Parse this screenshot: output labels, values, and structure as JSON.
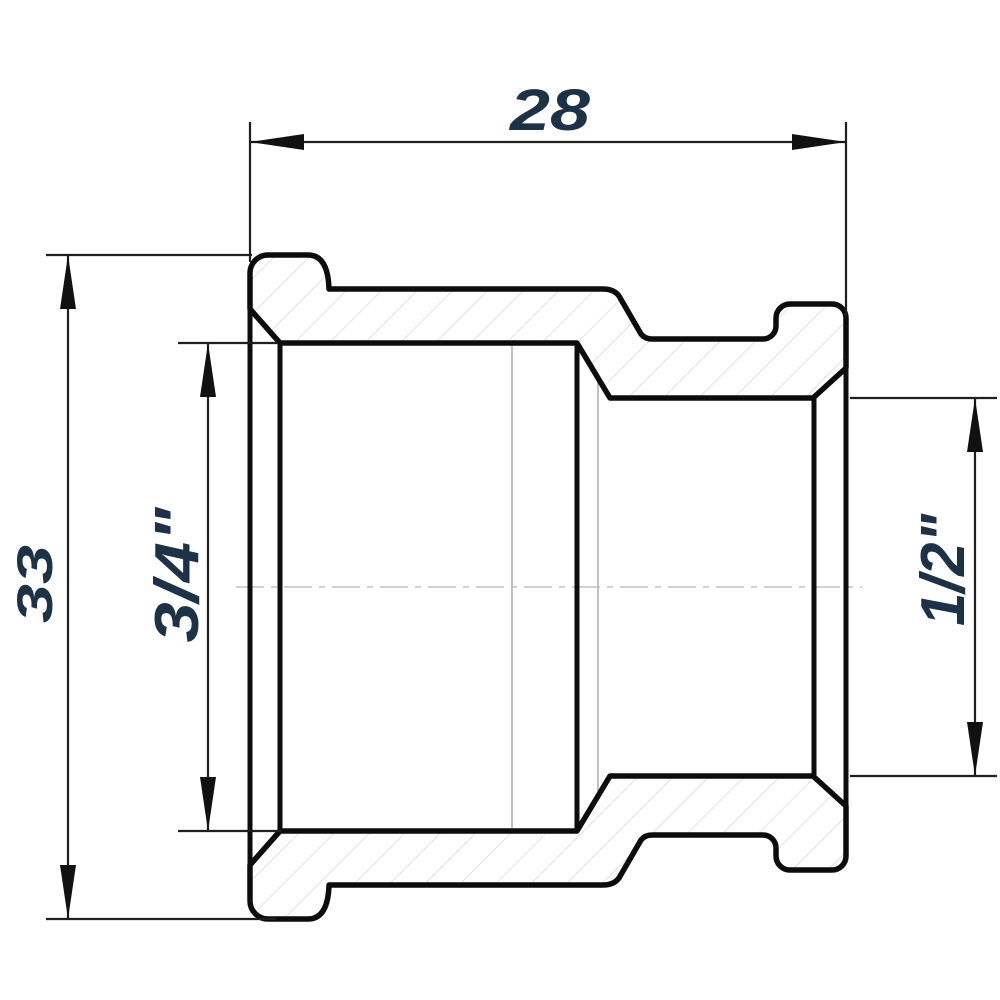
{
  "drawing": {
    "dimensions": {
      "width": "28",
      "height": "33",
      "left_thread": "3/4\"",
      "right_thread": "1/2\""
    },
    "colors": {
      "outline": "#0c0c0c",
      "dimension_lines": "#1f1f1f",
      "label_text": "#1d3147",
      "hatch": "#d8d8d8",
      "thread_lines": "#bababa",
      "centerline": "#c9c9c9",
      "background": "#ffffff"
    }
  }
}
